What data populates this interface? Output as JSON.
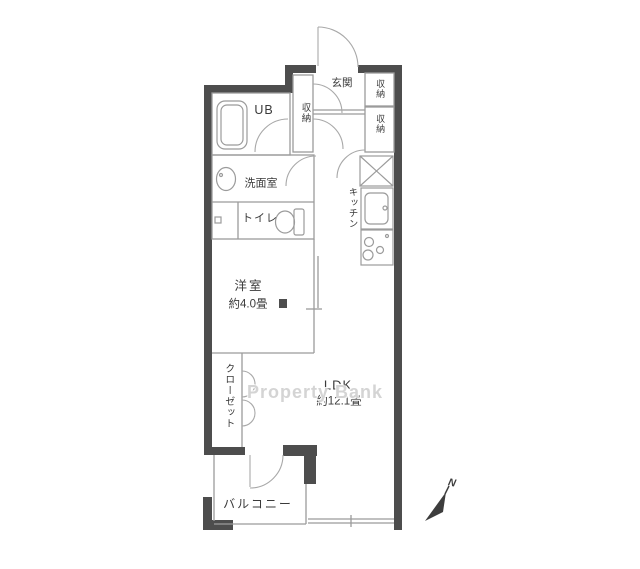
{
  "colors": {
    "wall": "#4d4d4d",
    "thin_line": "#9b9b9b",
    "arc_line": "#a8a8a8",
    "text": "#3a3a3a",
    "watermark": "#c8c8c8",
    "background": "#ffffff"
  },
  "floorplan": {
    "rooms": {
      "unit_bath": {
        "label": "UB"
      },
      "hall_storage": {
        "label": "収納"
      },
      "entrance": {
        "label": "玄関"
      },
      "storage_upper": {
        "label": "収納"
      },
      "storage_lower": {
        "label": "収納"
      },
      "kitchen": {
        "label": "キッチン"
      },
      "washroom": {
        "label": "洗面室"
      },
      "toilet": {
        "label": "トイレ"
      },
      "western_room": {
        "label": "洋室",
        "size": "約4.0畳"
      },
      "ldk": {
        "label": "LDK",
        "size": "約12.1畳"
      },
      "closet": {
        "label": "クローゼット"
      },
      "balcony": {
        "label": "バルコニー"
      }
    },
    "compass": {
      "label": "N"
    },
    "watermark": {
      "text": "Property Bank"
    }
  }
}
